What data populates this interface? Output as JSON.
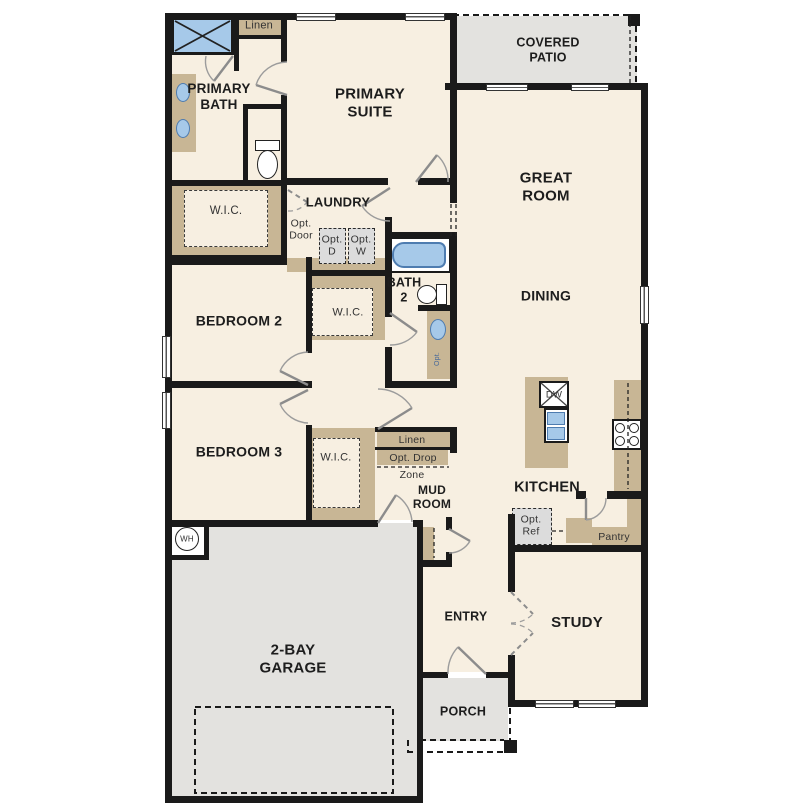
{
  "labels": {
    "primary_bath": "PRIMARY\nBATH",
    "primary_suite": "PRIMARY\nSUITE",
    "linen_upper": "Linen",
    "covered_patio": "COVERED\nPATIO",
    "great_room": "GREAT\nROOM",
    "wic_primary": "W.I.C.",
    "laundry": "LAUNDRY",
    "opt_door": "Opt.\nDoor",
    "opt_dryer": "Opt.\nD",
    "opt_washer": "Opt.\nW",
    "bath_2": "BATH\n2",
    "bedroom_2": "BEDROOM 2",
    "wic_bedroom2": "W.I.C.",
    "dining": "DINING",
    "bedroom_3": "BEDROOM 3",
    "wic_bedroom3": "W.I.C.",
    "linen_lower": "Linen",
    "opt_drop": "Opt. Drop",
    "zone": "Zone",
    "mud_room": "MUD\nROOM",
    "kitchen": "KITCHEN",
    "dishwasher": "DW",
    "opt_ref": "Opt.\nRef",
    "pantry": "Pantry",
    "water_heater": "WH",
    "garage": "2-BAY\nGARAGE",
    "entry": "ENTRY",
    "study": "STUDY",
    "porch": "PORCH",
    "opt_vanity": "Opt."
  },
  "colors": {
    "floor": "#f7efe1",
    "cabinet": "#c8b695",
    "exterior": "#e3e2df",
    "optional": "#dcdcdc",
    "blue": "#a6c9e9",
    "blue_dark": "#4e7cb0",
    "wall": "#1a1a1a"
  }
}
